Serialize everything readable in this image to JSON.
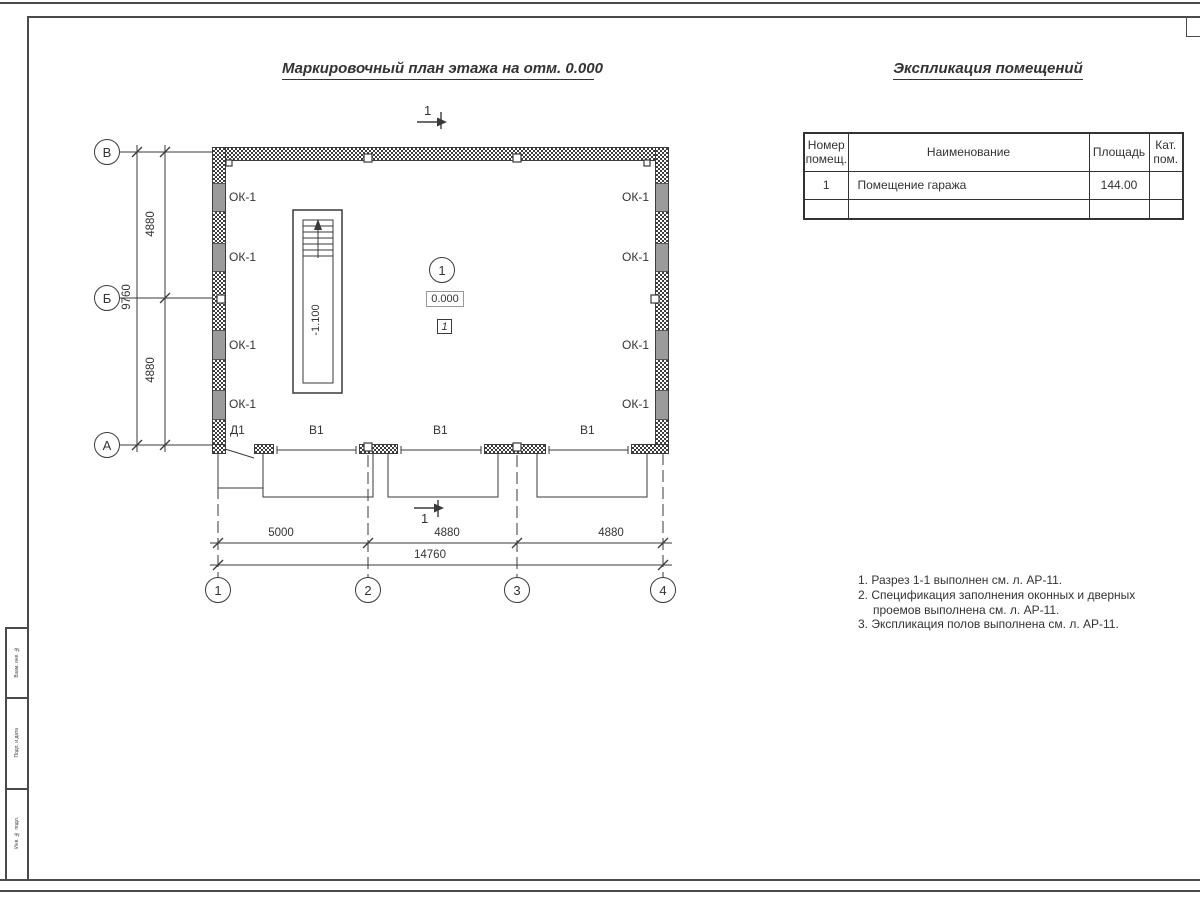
{
  "plan": {
    "title": "Маркировочный план этажа на отм. 0.000",
    "window_mark": "ОК-1",
    "door_mark": "Д1",
    "gate_mark": "В1",
    "section_mark": "1",
    "room_number": "1",
    "floor_elevation": "0.000",
    "pit_elevation": "-1.100",
    "floor_type_mark": "1",
    "axes_rows": [
      "В",
      "Б",
      "А"
    ],
    "axes_cols": [
      "1",
      "2",
      "3",
      "4"
    ],
    "dims": {
      "left_segments": [
        "4880",
        "4880"
      ],
      "left_total": "9760",
      "bottom_segments": [
        "5000",
        "4880",
        "4880"
      ],
      "bottom_total": "14760"
    }
  },
  "schedule": {
    "title": "Экспликация помещений",
    "columns": [
      "Номер помещ.",
      "Наименование",
      "Площадь",
      "Кат. пом."
    ],
    "rows": [
      {
        "num": "1",
        "name": "Помещение гаража",
        "area": "144.00",
        "cat": ""
      },
      {
        "num": "",
        "name": "",
        "area": "",
        "cat": ""
      }
    ]
  },
  "notes": {
    "lines": [
      "1. Разрез 1-1 выполнен см. л. АР-11.",
      "2. Спецификация заполнения оконных и дверных",
      "проемов выполнена см. л. АР-11.",
      "3. Экспликация полов выполнена см. л. АР-11."
    ]
  },
  "frame": {
    "labels": [
      "Взам. инв. №",
      "Подп. и дата",
      "Инв. № подл."
    ]
  },
  "colors": {
    "line": "#3a3a3a",
    "wall_fill": "#9b9b9b"
  }
}
